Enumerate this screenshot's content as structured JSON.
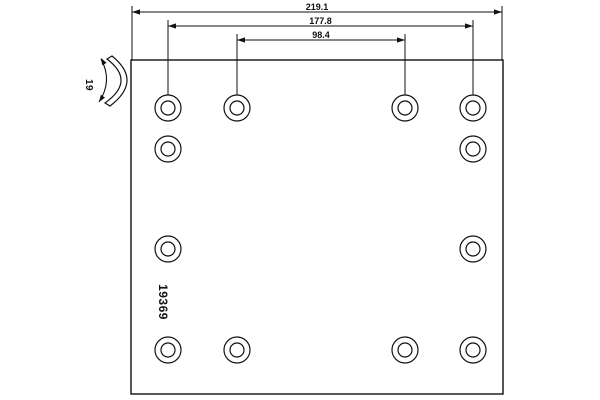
{
  "drawing": {
    "kind": "brake-lining technical drawing",
    "line_color": "#111111",
    "background_color": "#ffffff"
  },
  "part_number": "19369",
  "side_view": {
    "thickness_label": "19"
  },
  "dimensions": [
    {
      "label": "219.1",
      "x1": 132,
      "x2": 502,
      "y": 12,
      "ext_top": 6,
      "ext_bottom": 60
    },
    {
      "label": "177.8",
      "x1": 168,
      "x2": 473,
      "y": 26,
      "ext_top": 20,
      "ext_bottom": 95
    },
    {
      "label": "98.4",
      "x1": 237,
      "x2": 405,
      "y": 40,
      "ext_top": 34,
      "ext_bottom": 95
    }
  ],
  "plate": {
    "x": 131,
    "y": 60,
    "width": 372,
    "height": 334
  },
  "holes": {
    "outer_radius": 13,
    "inner_radius": 7,
    "centers": [
      {
        "x": 168,
        "y": 108
      },
      {
        "x": 237,
        "y": 108
      },
      {
        "x": 405,
        "y": 108
      },
      {
        "x": 473,
        "y": 108
      },
      {
        "x": 168,
        "y": 149
      },
      {
        "x": 473,
        "y": 149
      },
      {
        "x": 168,
        "y": 249
      },
      {
        "x": 473,
        "y": 249
      },
      {
        "x": 168,
        "y": 350
      },
      {
        "x": 237,
        "y": 350
      },
      {
        "x": 405,
        "y": 350
      },
      {
        "x": 473,
        "y": 350
      }
    ]
  }
}
